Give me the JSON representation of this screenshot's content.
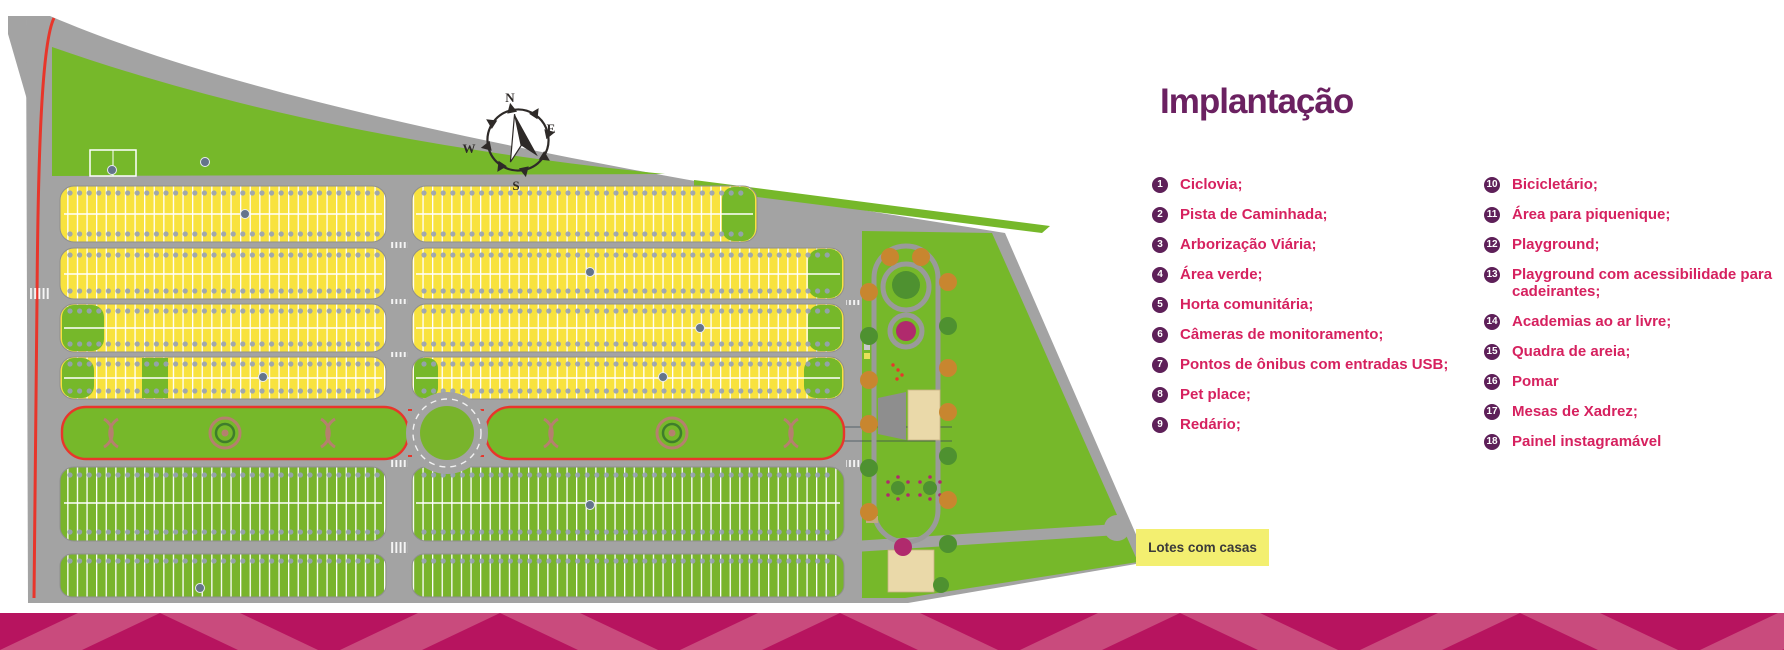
{
  "title": "Implantação",
  "compass": {
    "north": "N",
    "east": "E",
    "south": "S",
    "west": "W"
  },
  "map": {
    "house_lots_label": "Lotes com casas"
  },
  "legend": {
    "col1": [
      {
        "num": "1",
        "label": "Ciclovia;"
      },
      {
        "num": "2",
        "label": "Pista de Caminhada;"
      },
      {
        "num": "3",
        "label": "Arborização Viária;"
      },
      {
        "num": "4",
        "label": "Área verde;"
      },
      {
        "num": "5",
        "label": "Horta comunitária;"
      },
      {
        "num": "6",
        "label": "Câmeras de monitoramento;"
      },
      {
        "num": "7",
        "label": "Pontos de ônibus com entradas USB;"
      },
      {
        "num": "8",
        "label": "Pet place;"
      },
      {
        "num": "9",
        "label": "Redário;"
      }
    ],
    "col2": [
      {
        "num": "10",
        "label": "Bicicletário;"
      },
      {
        "num": "11",
        "label": "Área para piquenique;"
      },
      {
        "num": "12",
        "label": "Playground;"
      },
      {
        "num": "13",
        "label": "Playground com acessibilidade para cadeirantes;"
      },
      {
        "num": "14",
        "label": "Academias ao ar livre;"
      },
      {
        "num": "15",
        "label": "Quadra de areia;"
      },
      {
        "num": "16",
        "label": "Pomar"
      },
      {
        "num": "17",
        "label": "Mesas de Xadrez;"
      },
      {
        "num": "18",
        "label": "Painel instagramável"
      }
    ]
  },
  "colors": {
    "title_purple": "#6b2161",
    "legend_pink": "#d6215f",
    "badge_purple": "#5e2059",
    "band_magenta": "#b7145f",
    "band_stripe": "#c94b7d",
    "map_green": "#76b82a",
    "lot_yellow": "#f8e23e",
    "road_gray": "#a3a3a3",
    "track_red": "#e8362b",
    "label_yellow": "#f3ef70"
  }
}
